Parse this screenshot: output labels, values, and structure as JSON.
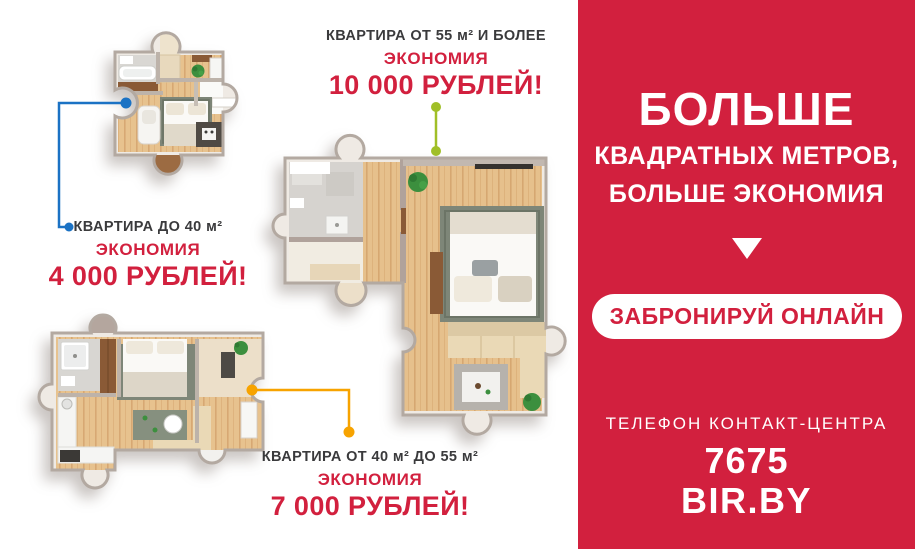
{
  "plans": [
    {
      "id": "small",
      "label": "КВАРТИРА ДО 40 м²",
      "savings_word": "ЭКОНОМИЯ",
      "savings_amount": "4 000 РУБЛЕЙ!"
    },
    {
      "id": "large",
      "label": "КВАРТИРА ОТ 55 м² И БОЛЕЕ",
      "savings_word": "ЭКОНОМИЯ",
      "savings_amount": "10 000 РУБЛЕЙ!"
    },
    {
      "id": "medium",
      "label": "КВАРТИРА ОТ 40 м² ДО 55 м²",
      "savings_word": "ЭКОНОМИЯ",
      "savings_amount": "7 000 РУБЛЕЙ!"
    }
  ],
  "sidebar": {
    "headline_1": "БОЛЬШЕ",
    "headline_2": "КВАДРАТНЫХ МЕТРОВ,",
    "headline_3": "БОЛЬШЕ ЭКОНОМИЯ",
    "arrow_icon": "down-arrow",
    "cta_label": "ЗАБРОНИРУЙ ОНЛАЙН",
    "phone_label": "ТЕЛЕФОН КОНТАКТ-ЦЕНТРА",
    "phone_number": "7675",
    "website": "BIR.BY"
  },
  "colors": {
    "panel_red": "#d2203e",
    "savings_red": "#d2203e",
    "label_dark": "#3a3a3c",
    "connector_blue": "#1b72c4",
    "connector_green": "#a0bf27",
    "connector_orange": "#f7a300"
  }
}
